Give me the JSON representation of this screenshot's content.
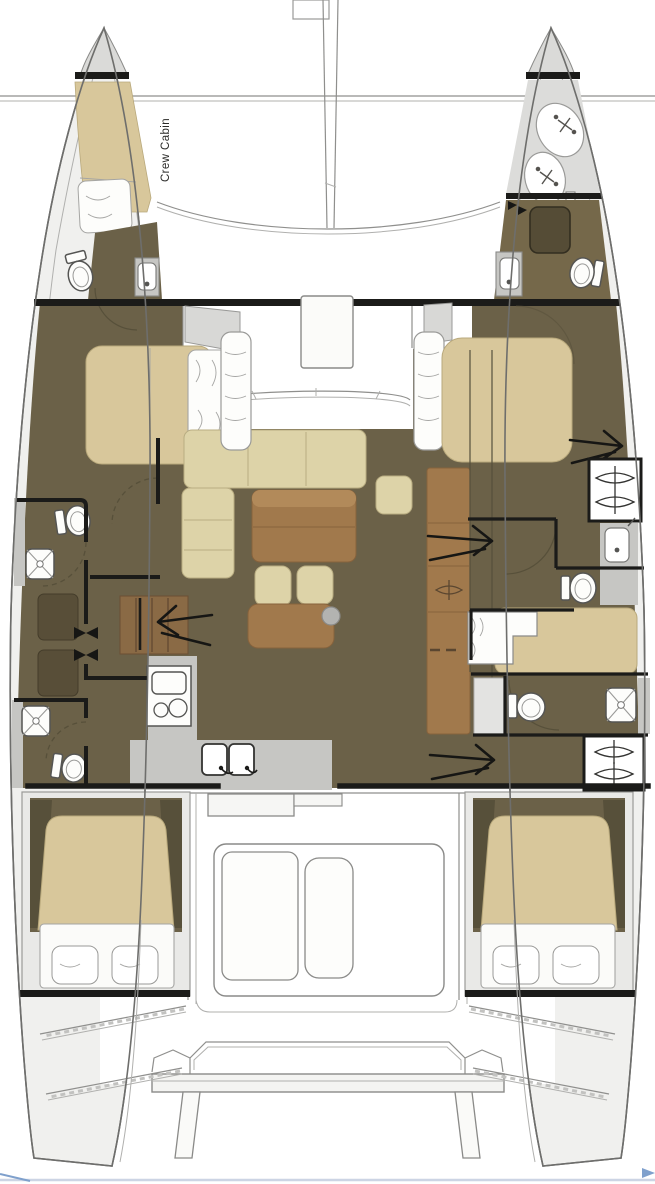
{
  "labels": {
    "crew_cabin": "Crew Cabin"
  },
  "colors": {
    "background": "#ffffff",
    "hull_fill": "#f0f0ee",
    "hull_stroke": "#6e6e6c",
    "deck_gray": "#dadad8",
    "floor_olive": "#6b6148",
    "floor_brown_olive": "#75684a",
    "bed_tan": "#d8c79b",
    "sofa_cream": "#ddd3a8",
    "wood_brown": "#a1794c",
    "wood_brown_light": "#b28a5a",
    "wood_dark": "#8a6a45",
    "locker_dark": "#584e38",
    "counter_gray": "#c6c6c3",
    "fixture_white": "#fdfdfb",
    "wall_black": "#1b1b19",
    "line_gray": "#8f8f8d",
    "accent_blue": "#7fa0cc"
  },
  "icons": {
    "toilet-icon": "ellipse bowl with tank rect",
    "shower-icon": "rounded square with X diagonals and drain dot",
    "sink-icon": "basin with faucet dot",
    "double-sink-icon": "two basins with faucets",
    "stove-icon": "oven rect with two burner circles",
    "hanging-locker-icon": "bow-tie hanger glyph",
    "stairs-arrow-icon": "long arrow with open head",
    "cleat-icon": "cross with dots",
    "mast-icon": "tapered double line",
    "direction-mark-icon": "blue chevron"
  },
  "fixtures": {
    "toilets": 6,
    "showers": 3,
    "sinks": 3,
    "double_sinks": 1,
    "stoves": 1,
    "beds": 6,
    "hanging_lockers": 4,
    "stairs_arrows": 4,
    "cockpit_tables": 1,
    "salon_tables": 1
  }
}
